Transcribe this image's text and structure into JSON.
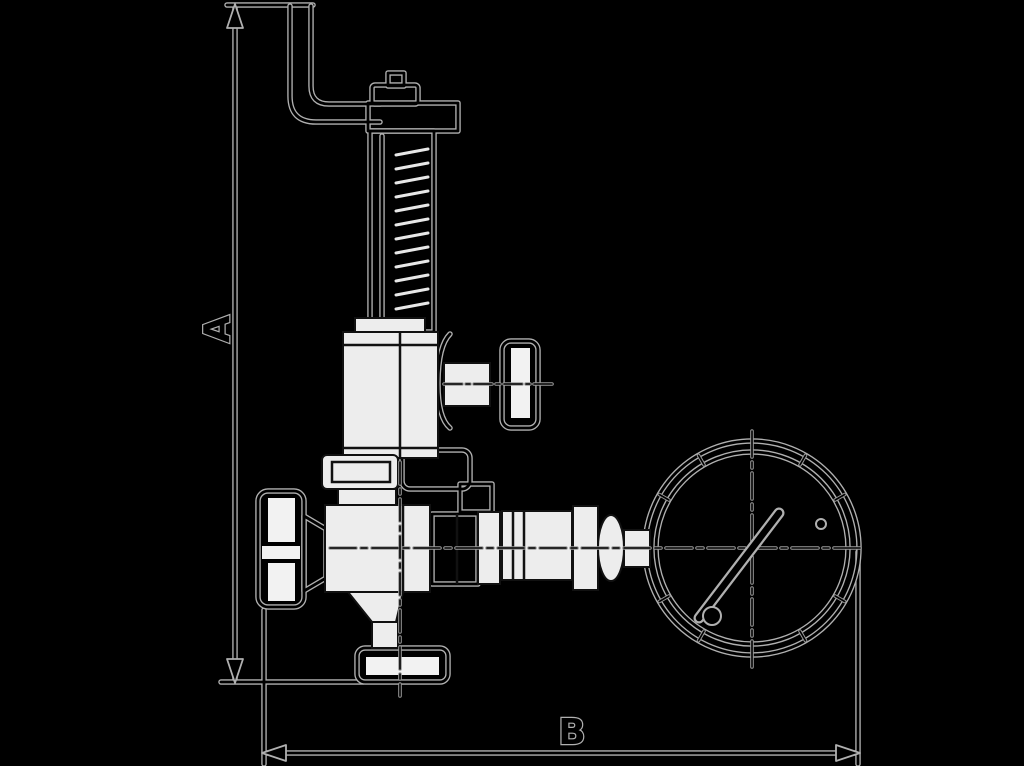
{
  "page": {
    "background_color": "#000000"
  },
  "diagram": {
    "kind": "technical-dimension-drawing",
    "subject": "spring-loaded safety relief valve with shut-off knob, side plug, bottom flange and connected pressure gauge",
    "colors": {
      "background": "#000000",
      "halo_line": "#b0b0b0",
      "ink_line": "#000000",
      "face_fill": "#ededed"
    },
    "dimensions": {
      "vertical_label": "A",
      "horizontal_label": "B"
    },
    "components": [
      "vent-pipe",
      "top-cap",
      "spring-housing",
      "bonnet",
      "side-outlet-plug",
      "union-flange",
      "valve-body",
      "shutoff-knob",
      "funnel-outlet",
      "bottom-flange",
      "gauge-piping",
      "pressure-gauge",
      "gauge-needle"
    ]
  }
}
